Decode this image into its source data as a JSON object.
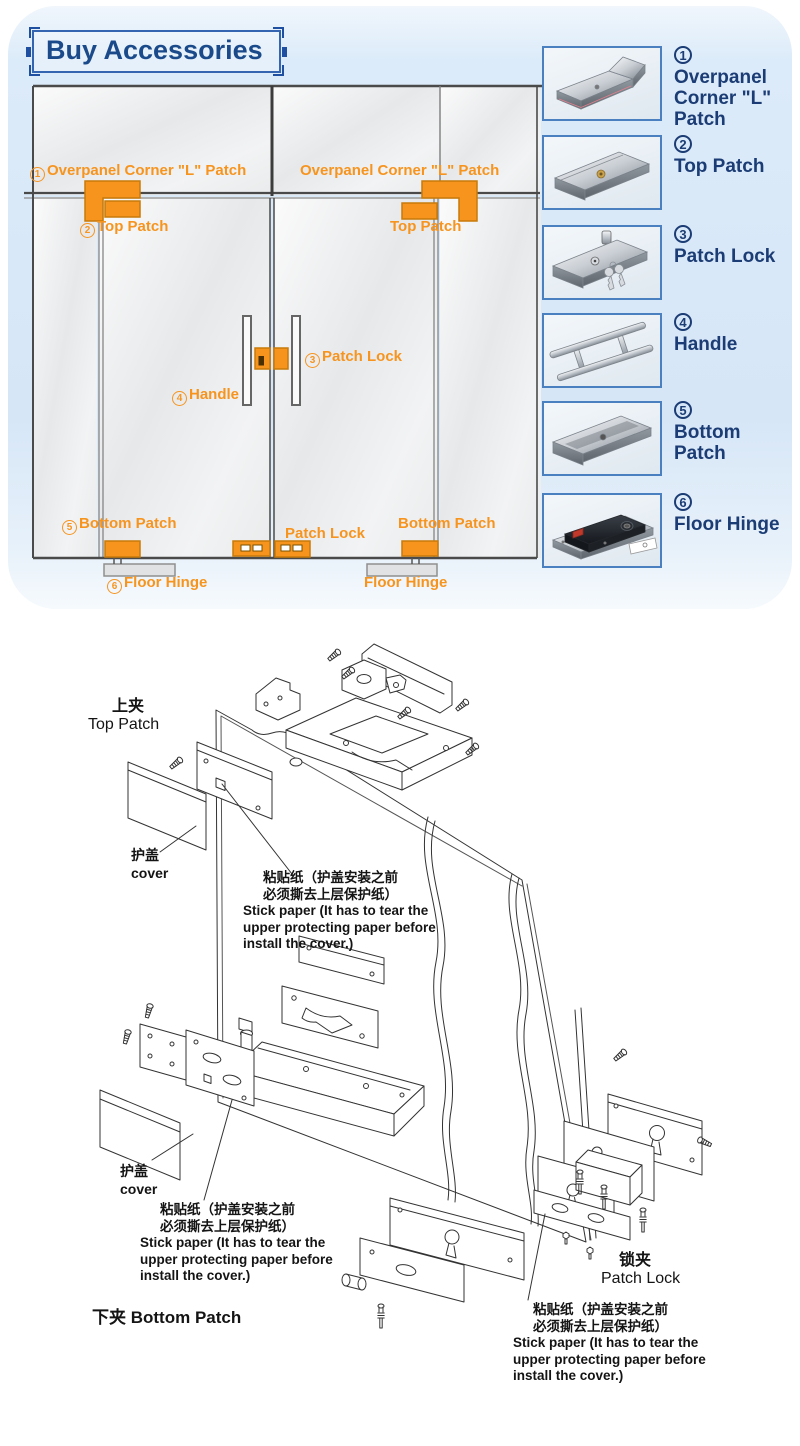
{
  "panel": {
    "title": "Buy Accessories"
  },
  "door_diagram": {
    "labels": {
      "overpanel_left": {
        "num": "1",
        "text": "Overpanel Corner \"L\" Patch"
      },
      "overpanel_right": "Overpanel Corner \"L\" Patch",
      "top_patch_left": {
        "num": "2",
        "text": "Top Patch"
      },
      "top_patch_right": "Top Patch",
      "patch_lock": {
        "num": "3",
        "text": "Patch Lock"
      },
      "handle": {
        "num": "4",
        "text": "Handle"
      },
      "bottom_patch_left": {
        "num": "5",
        "text": "Bottom Patch"
      },
      "patch_lock_bottom": "Patch Lock",
      "bottom_patch_right": "Bottom Patch",
      "floor_hinge_left": {
        "num": "6",
        "text": "Floor Hinge"
      },
      "floor_hinge_right": "Floor Hinge"
    }
  },
  "accessories": {
    "items": [
      {
        "num": "1",
        "label": "Overpanel Corner \"L\" Patch",
        "photo": "corner-l-patch"
      },
      {
        "num": "2",
        "label": "Top Patch",
        "photo": "top-patch"
      },
      {
        "num": "3",
        "label": "Patch Lock",
        "photo": "patch-lock"
      },
      {
        "num": "4",
        "label": "Handle",
        "photo": "handle"
      },
      {
        "num": "5",
        "label": "Bottom Patch",
        "photo": "bottom-patch"
      },
      {
        "num": "6",
        "label": "Floor Hinge",
        "photo": "floor-hinge"
      }
    ]
  },
  "exploded": {
    "top_patch": {
      "zh": "上夹",
      "en": "Top Patch"
    },
    "cover": {
      "zh": "护盖",
      "en": "cover"
    },
    "stick_paper": {
      "zh1": "粘贴纸（护盖安装之前",
      "zh2": "必须撕去上层保护纸）",
      "en1": "Stick paper (It has to tear the",
      "en2": "upper protecting paper before",
      "en3": "install the cover.)"
    },
    "bottom_patch": {
      "zh": "下夹",
      "en": "Bottom Patch"
    },
    "patch_lock": {
      "zh": "锁夹",
      "en": "Patch Lock"
    }
  },
  "colors": {
    "accent_orange": "#F7941E",
    "navy_text": "#1B3C74",
    "title_blue": "#1B4A8A",
    "panel_blue": "#D6E6F7",
    "photo_border": "#4B80C0",
    "line_gray": "#333333"
  }
}
